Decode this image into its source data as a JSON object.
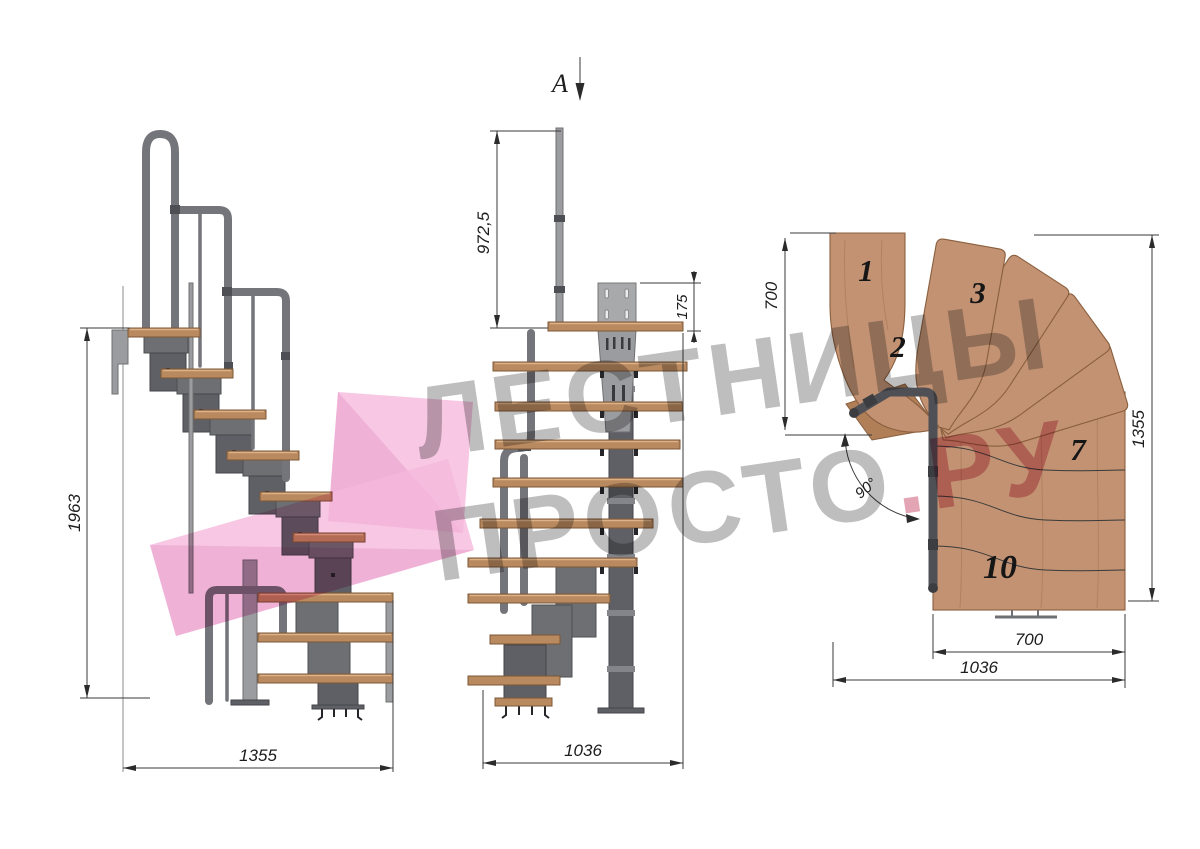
{
  "drawing": {
    "watermark": {
      "line1": "ЛЕСТНИЦЫ",
      "line2": "ПРОСТО",
      "line2_accent": ".РУ",
      "gray_color": "#8f8f8f",
      "accent_color": "#c84a68",
      "logo_color": "#f5b9dc"
    },
    "section_marker": {
      "label": "A"
    },
    "views": {
      "side": {
        "title": "side elevation",
        "height_mm": "1963",
        "width_mm": "1355"
      },
      "front": {
        "title": "front elevation",
        "handrail_height_mm": "972,5",
        "bracket_height_mm": "175",
        "width_mm": "1036"
      },
      "plan": {
        "title": "top plan",
        "landing_depth_mm": "700",
        "length_mm": "1355",
        "flight_width_mm": "700",
        "total_width_mm": "1036",
        "turn_angle": "90°",
        "tread_labels": [
          "1",
          "2",
          "3",
          "7",
          "10"
        ]
      }
    },
    "colors": {
      "wood": "#c29273",
      "wood_dark": "#8a5f3e",
      "metal": "#6a6b70",
      "metal_light": "#a8a9ab",
      "dimension_lines": "#3a3a3a"
    }
  }
}
